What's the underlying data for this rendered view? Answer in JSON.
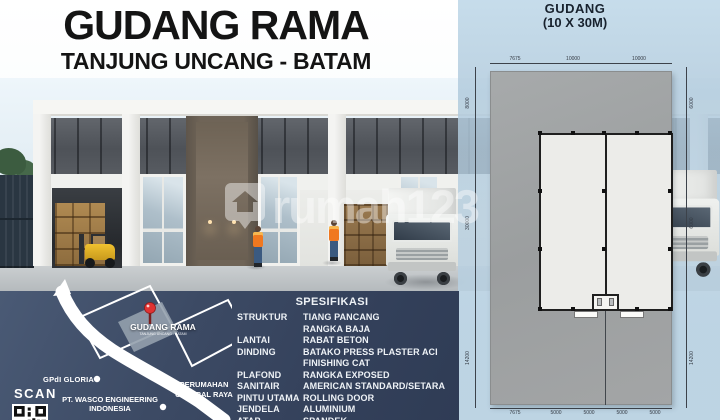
{
  "header": {
    "title": "GUDANG RAMA",
    "subtitle": "TANJUNG UNCANG - BATAM"
  },
  "plan": {
    "title_line1": "GUDANG",
    "title_line2": "(10 X 30M)",
    "dimensions": {
      "top": [
        "7675",
        "10000",
        "10000"
      ],
      "bottom": [
        "7675",
        "5000",
        "5000",
        "5000",
        "5000"
      ],
      "left": [
        "8000",
        "30000",
        "14200"
      ],
      "right": [
        "6000",
        "6000",
        "14200"
      ]
    }
  },
  "specs": {
    "heading": "SPESIFIKASI",
    "rows": [
      {
        "label": "STRUKTUR",
        "value": "TIANG PANCANG"
      },
      {
        "label": "",
        "value": "RANGKA BAJA"
      },
      {
        "label": "LANTAI",
        "value": "RABAT BETON"
      },
      {
        "label": "DINDING",
        "value": "BATAKO PRESS PLASTER ACI"
      },
      {
        "label": "",
        "value": "FINISHING CAT"
      },
      {
        "label": "PLAFOND",
        "value": "RANGKA EXPOSED"
      },
      {
        "label": "SANITAIR",
        "value": "AMERICAN STANDARD/SETARA"
      },
      {
        "label": "PINTU UTAMA",
        "value": "ROLLING DOOR"
      },
      {
        "label": "JENDELA",
        "value": "ALUMINIUM"
      },
      {
        "label": "ATAP",
        "value": "SPANDEK"
      }
    ]
  },
  "map": {
    "pin_label": "GUDANG RAMA",
    "pin_sublabel": "TANJUNG UNCANG - BATAM",
    "pois": [
      {
        "name": "GPdI GLORIA",
        "lines": [
          "GPdI GLORIA"
        ]
      },
      {
        "name": "PT. WASCO ENGINEERING INDONESIA",
        "lines": [
          "PT. WASCO ENGINEERING",
          "INDONESIA"
        ]
      },
      {
        "name": "PERUMAHAN CENTRAL RAYA",
        "lines": [
          "PERUMAHAN",
          "CENTRAL RAYA"
        ]
      }
    ],
    "scan_label": "SCAN"
  },
  "watermark": {
    "text": "rumah123"
  },
  "icons": {
    "map_pin_icon": "red location pin",
    "qr_code_icon": "QR code",
    "watermark_logo_icon": "house-in-pin logo"
  },
  "colors": {
    "navy_panel": "#3a4862",
    "panel_blue": "#bad2e4",
    "pin_red": "#e03232",
    "title_text": "#141414",
    "spec_text": "#ffffff",
    "forklift_yellow": "#e8b92d",
    "vest_orange": "#f07820"
  }
}
